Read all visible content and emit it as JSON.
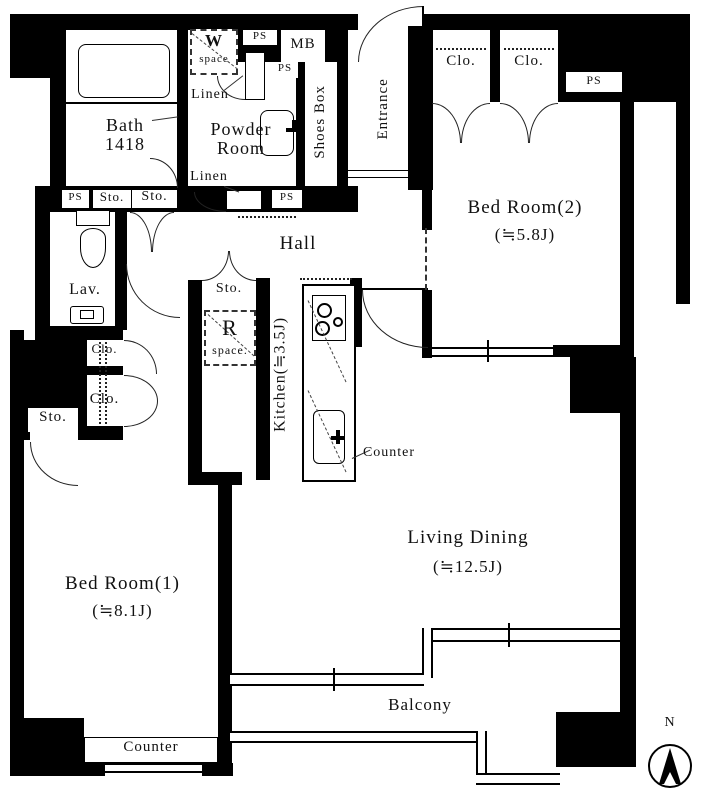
{
  "labels": {
    "bath_line1": "Bath",
    "bath_line2": "1418",
    "powder_line1": "Powder",
    "powder_line2": "Room",
    "shoes_box": "Shoes Box",
    "entrance": "Entrance",
    "hall": "Hall",
    "lav": "Lav.",
    "kitchen": "Kitchen(≒3.5J)",
    "bedroom2_name": "Bed Room(2)",
    "bedroom2_size": "(≒5.8J)",
    "bedroom1_name": "Bed Room(1)",
    "bedroom1_size": "(≒8.1J)",
    "living_name": "Living Dining",
    "living_size": "(≒12.5J)",
    "balcony": "Balcony",
    "counter": "Counter",
    "w_space_letter": "W",
    "w_space_word": "space",
    "r_space_letter": "R",
    "r_space_word": "space.",
    "mb": "MB",
    "ps": "PS",
    "sto": "Sto.",
    "clo": "Clo.",
    "linen": "Linen",
    "north": "N"
  },
  "colors": {
    "wall": "#000000",
    "background": "#ffffff",
    "line": "#1a1a1a"
  }
}
